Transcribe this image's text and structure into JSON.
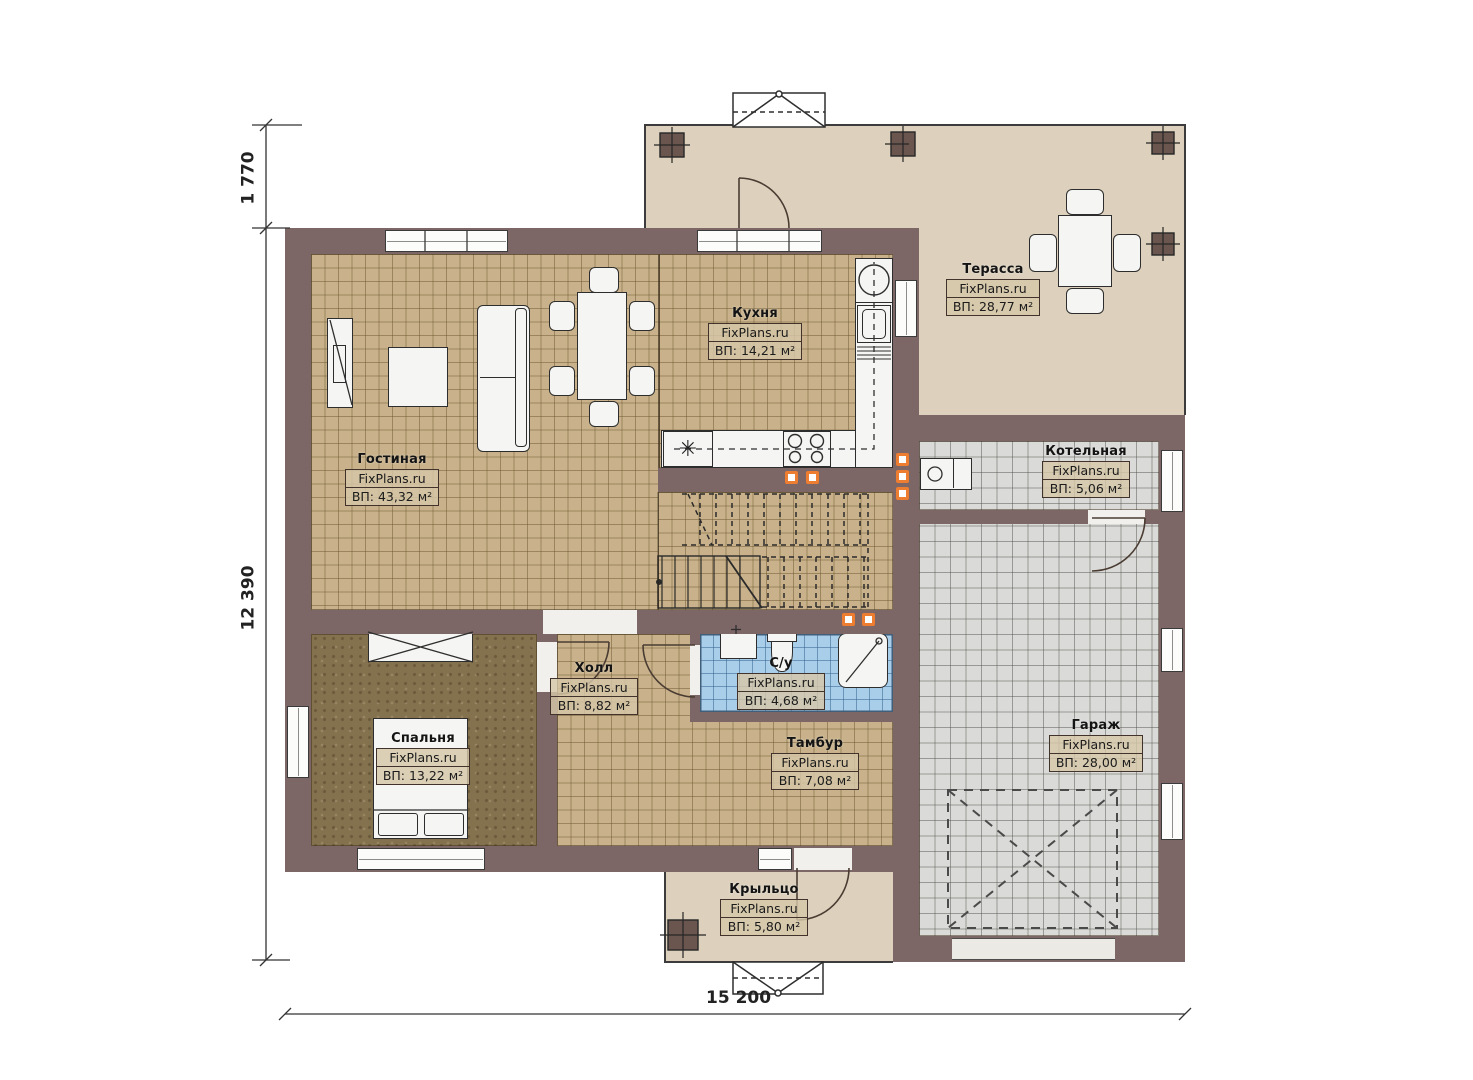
{
  "watermark": "FixPlans.ru",
  "rooms": [
    {
      "key": "living",
      "name": "Гостиная",
      "area": "ВП: 43,32 м²"
    },
    {
      "key": "kitchen",
      "name": "Кухня",
      "area": "ВП: 14,21 м²"
    },
    {
      "key": "terrace",
      "name": "Терасса",
      "area": "ВП: 28,77 м²"
    },
    {
      "key": "boiler",
      "name": "Котельная",
      "area": "ВП: 5,06 м²"
    },
    {
      "key": "hall",
      "name": "Холл",
      "area": "ВП: 8,82 м²"
    },
    {
      "key": "wc",
      "name": "С/у",
      "area": "ВП: 4,68 м²"
    },
    {
      "key": "bedroom",
      "name": "Спальня",
      "area": "ВП: 13,22 м²"
    },
    {
      "key": "tambour",
      "name": "Тамбур",
      "area": "ВП: 7,08 м²"
    },
    {
      "key": "garage",
      "name": "Гараж",
      "area": "ВП: 28,00 м²"
    },
    {
      "key": "porch",
      "name": "Крыльцо",
      "area": "ВП: 5,80 м²"
    }
  ],
  "dimensions": {
    "terrace_depth": "1 770",
    "house_depth": "12 390",
    "house_width": "15 200"
  },
  "glyphs": {
    "appliance_asterisk": "✳"
  },
  "colors": {
    "wall": "#7c6666",
    "tan_tile": "#c9b28b",
    "gray_tile": "#dadbd8",
    "blue_tile": "#a9cee9",
    "bedroom_floor": "#84714d",
    "outdoor": "#ddd1bd",
    "outlet_accent": "#ed7d31"
  }
}
